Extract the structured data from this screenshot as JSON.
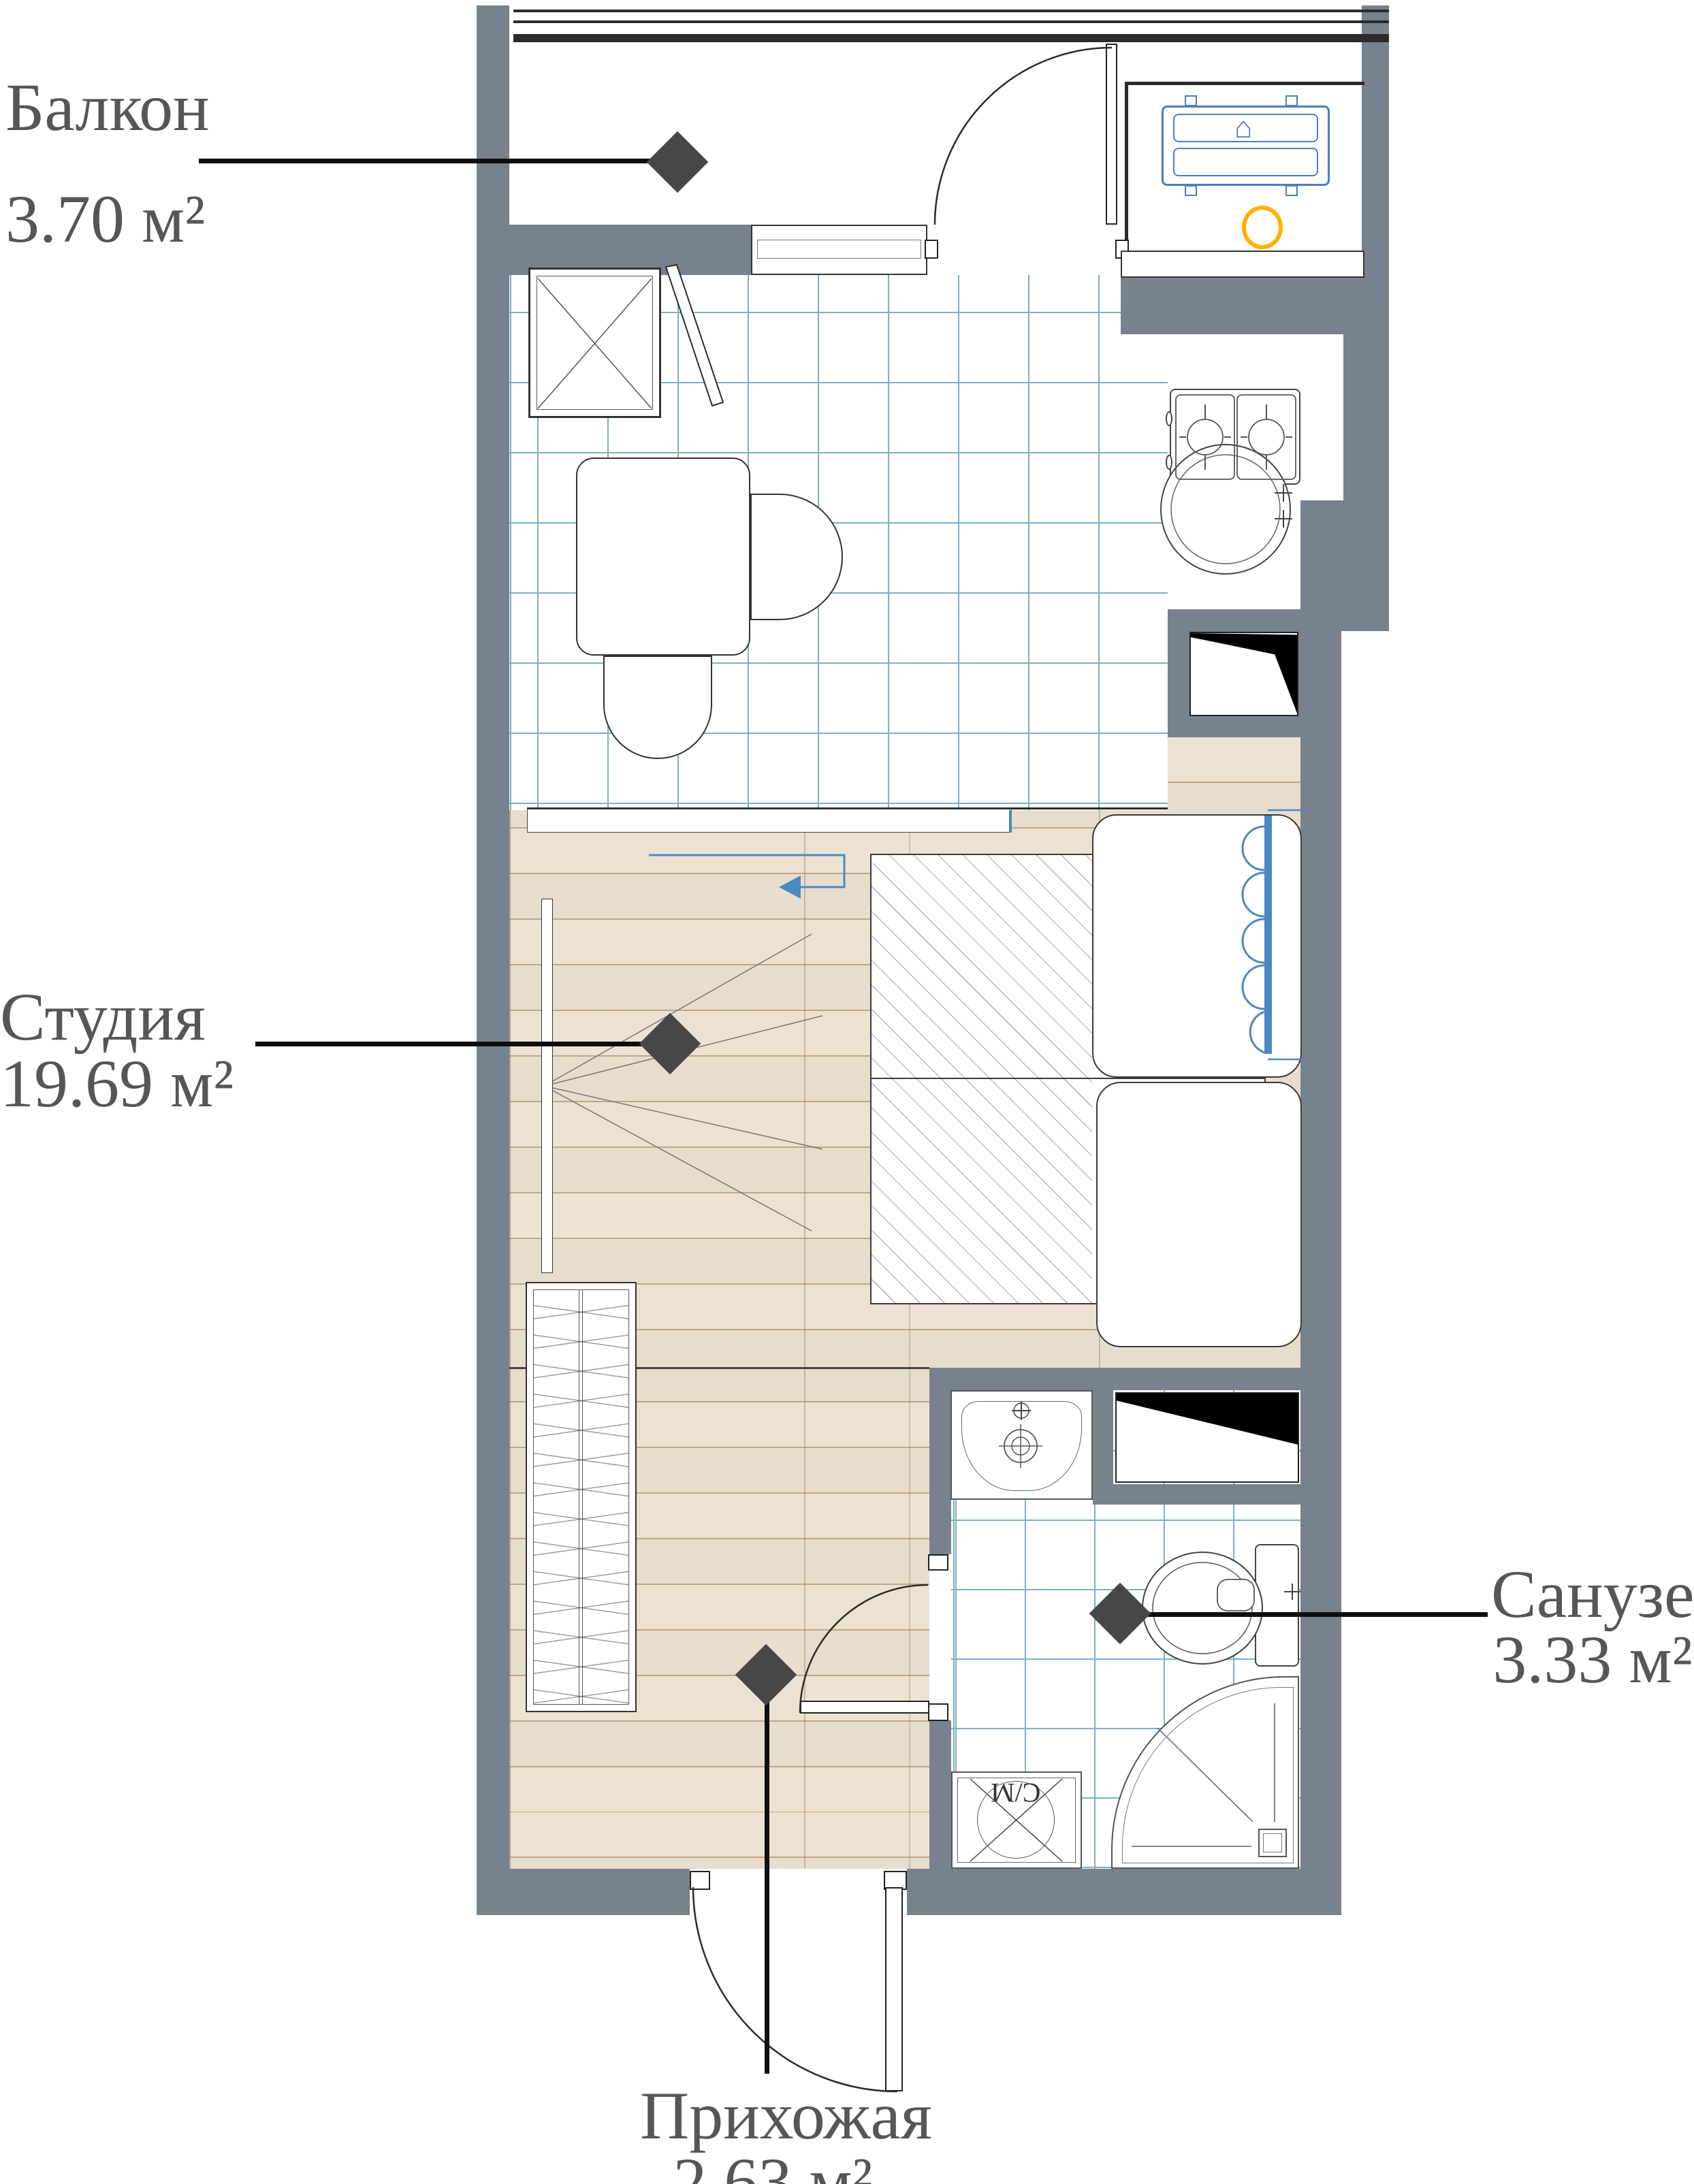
{
  "plan": {
    "title": "Studio apartment floor plan",
    "rooms": [
      {
        "name": "Балкон",
        "area": "3.70 м²"
      },
      {
        "name": "Студия",
        "area": "19.69 м²"
      },
      {
        "name": "Санузел",
        "area": "3.33 м²"
      },
      {
        "name": "Прихожая",
        "area": "2.63 м²"
      }
    ],
    "appliance_labels": {
      "washing_machine": "С/М"
    },
    "icons": {
      "vent": "⌂"
    },
    "colors": {
      "wall": "#76828E",
      "tile_line": "#7FAEC6",
      "floor": "#EDE2D2",
      "label_text": "#54565A",
      "marker": "#474747",
      "appliance_blue": "#4D7EBB",
      "accent_orange": "#FFB000",
      "radiator_blue": "#4C87C5"
    }
  }
}
